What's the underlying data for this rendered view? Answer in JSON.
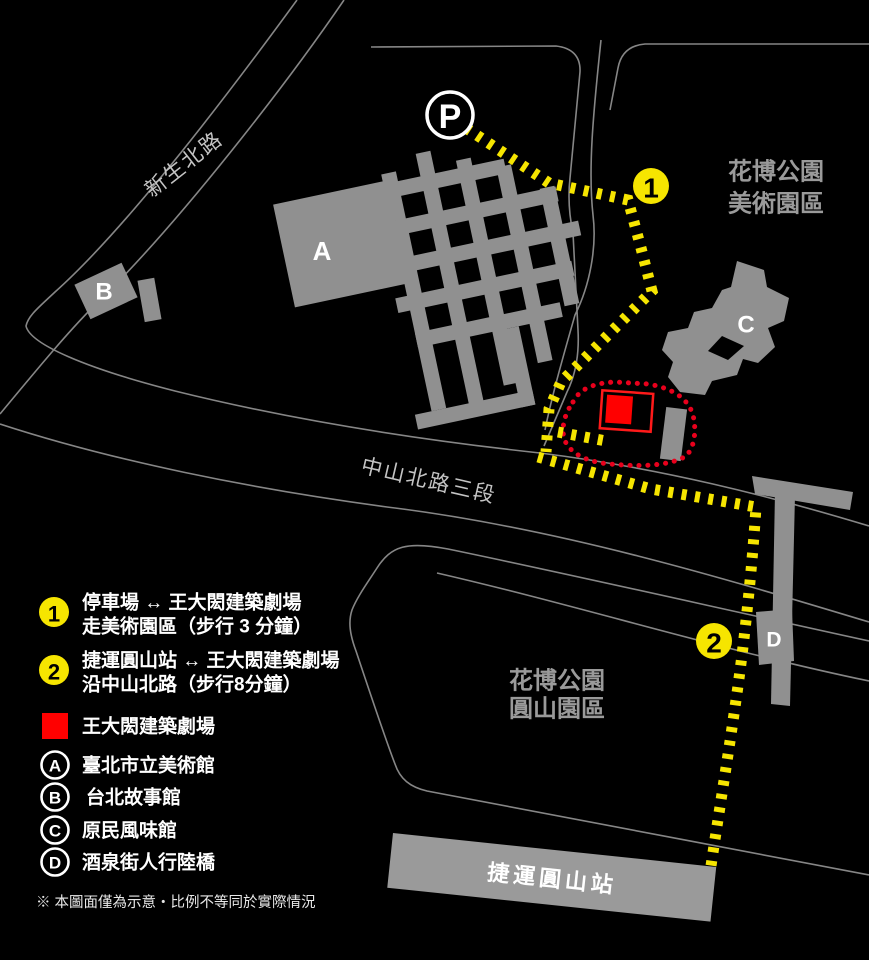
{
  "map": {
    "parking": "P",
    "marker1": "1",
    "marker2": "2",
    "building_a": "A",
    "building_b": "B",
    "building_c": "C",
    "building_d": "D",
    "station": "捷運圓山站",
    "road_xinsheng": "新生北路",
    "road_zhongshan": "中山北路三段",
    "area_art_line1": "花博公園",
    "area_art_line2": "美術園區",
    "area_yuanshan_line1": "花博公園",
    "area_yuanshan_line2": "圓山園區"
  },
  "legend": {
    "route1_num": "1",
    "route1_line1": "停車場 ↔ 王大閎建築劇場",
    "route1_line2": "走美術園區（步行 3 分鐘）",
    "route2_num": "2",
    "route2_line1": "捷運圓山站 ↔ 王大閎建築劇場",
    "route2_line2": "沿中山北路（步行8分鐘）",
    "venue": "王大閎建築劇場",
    "a": "臺北市立美術館",
    "b": "台北故事館",
    "c": "原民風味館",
    "d": "酒泉街人行陸橋",
    "note": "※ 本圖面僅為示意‧比例不等同於實際情況"
  },
  "colors": {
    "route_yellow": "#f6e500",
    "venue_red": "#ff0000",
    "venue_dotted_red": "#e8001c",
    "building_gray": "#909090",
    "road_line_gray": "#868686",
    "area_label_gray": "#9a9a9a",
    "background": "#000000"
  }
}
